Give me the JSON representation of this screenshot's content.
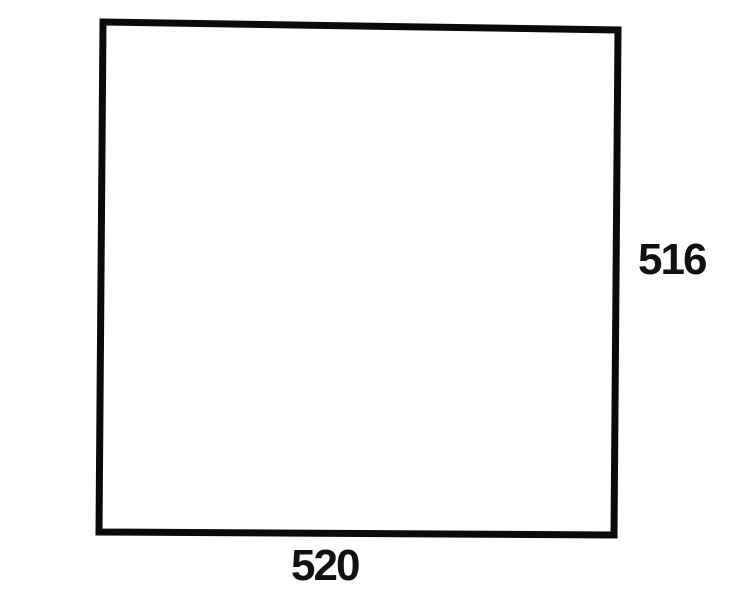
{
  "colors": {
    "background": "#ffffff",
    "stroke": "#0b0b0b",
    "text": "#111111"
  },
  "figure": {
    "shape": "quadrilateral",
    "labels": {
      "right_side": "516",
      "bottom_side": "520"
    }
  }
}
